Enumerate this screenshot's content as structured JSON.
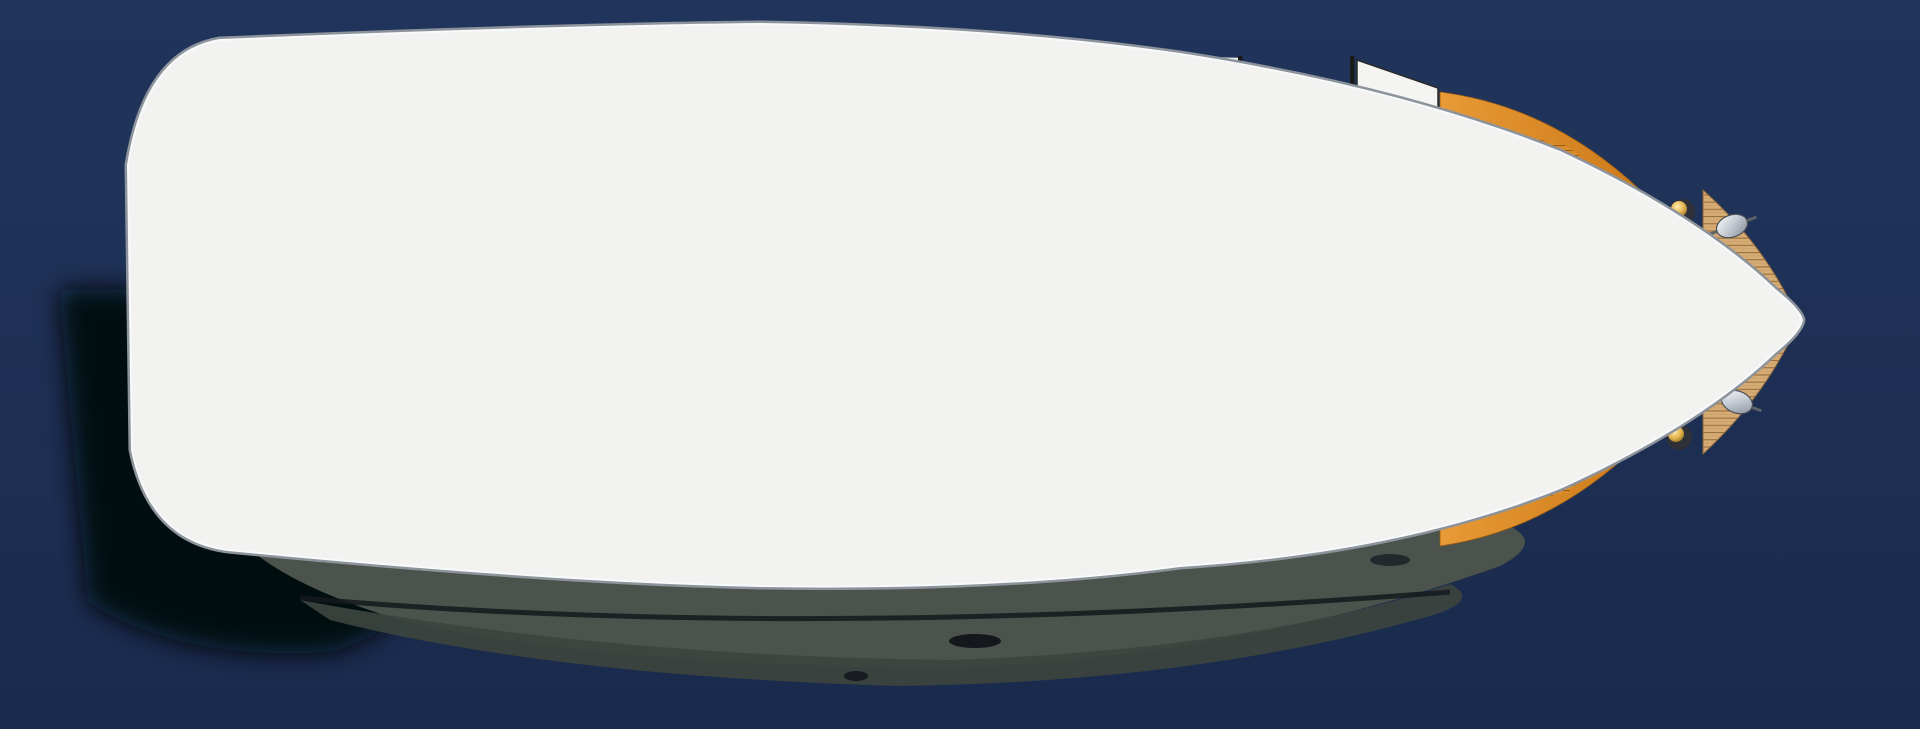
{
  "scene": {
    "description": "Top-down deck and interior floor plan of a motor yacht rendered over dark blue water",
    "view": "plan-view"
  },
  "colors": {
    "waterTop": "#21355c",
    "waterBottom": "#182849",
    "hullWhite": "#f2f3f1",
    "gunwaleGray": "#8d939b",
    "gunwaleHighlight": "#f7f9fa",
    "teak": "#d6ab74",
    "teakLine": "#96703f",
    "floorBeige": "#ddc695",
    "upholsteryNavy": "#242b3a",
    "cockpitWellBlack": "#05070d",
    "cushionWhite": "#fdfdfd",
    "furnitureOrange": "#d8882a",
    "tableRim": "#c9a06a",
    "cockpitTableWood": "#8d7350",
    "compassDark": "#6d4012",
    "compassLight": "#f2d9a4",
    "terrazzoBase": "#f3f3f0",
    "counterGray": "#a79e93",
    "stoveBlack": "#141414",
    "burnerRed": "#cc2229",
    "stepsWood": "#a9572c",
    "pillowPurple": "#ba8fc2",
    "lampGold": "#e0b04a",
    "wallBlack": "#1a1a1a",
    "hullShadow": "#4b534c",
    "hullShadowDark": "#3c443e",
    "sternShadow": "#04070c",
    "arrowBlack": "#111111",
    "toiletWhite": "#fafafa",
    "steelRim": "#c6ccd2"
  },
  "features": {
    "water": "Water",
    "hull": "Hull shadow at waterline",
    "deck": "Main deck",
    "aft_deck": "Aft deck cockpit with teak planking",
    "stern_netting_upper": "Stern rope netting (port)",
    "stern_netting_lower": "Stern rope netting (starboard)",
    "windscreen": "Metallic windscreen panel",
    "cockpit_bench": "C-shaped cockpit lounge with navy cushions",
    "cockpit_pillows": "White deck pillows",
    "cockpit_table": "Oval cockpit table with compass rose inlay",
    "engine_hatch": "Teak engine hatch",
    "boat_hook": "Boat hook",
    "saloon": "Saloon",
    "saloon_floor": "Saloon sole",
    "saloon_cabinet": "Saloon sideboard cabinets",
    "saloon_sofa": "Saloon sofa with navy cushions",
    "sofa_pillows": "White sofa pillows",
    "saloon_table": "Oval saloon table with compass rose inlay",
    "tv_panel": "Wall-mounted flat screen",
    "control_panel": "Appliance control panel",
    "head": "Head compartment with terrazzo sole",
    "toilet": "Marine toilet",
    "head_basin": "Head washbasin",
    "wet_room": "Washroom compartment",
    "round_sink": "Round stainless washbasin",
    "companionway": "Companionway steps",
    "direction_arrow": "Direction-down arrow",
    "corridor": "Lower lobby and galley sole",
    "galley": "U-shaped galley counter",
    "cooktop": "Four-burner ceramic cooktop",
    "galley_sink": "Round stainless galley sink",
    "locker_door": "Open locker door",
    "fruit_bowl": "Fruit bowl",
    "serving_plate": "Serving plate",
    "wardrobe_top": "Forward hanging locker (port)",
    "wardrobe_bottom": "Forward hanging locker (starboard)",
    "fore_cabin": "Forward cabin",
    "v_berth": "V-berth mattress",
    "berth_pillow_1": "Berth pillow",
    "berth_pillow_2": "Berth pillow",
    "reading_lamp_1": "Reading lamp",
    "reading_lamp_2": "Reading lamp",
    "bow_deck": "Teak foredeck",
    "cleat_1": "Mooring cleat",
    "cleat_2": "Mooring cleat",
    "cabin_doors": "Cabin doors"
  }
}
